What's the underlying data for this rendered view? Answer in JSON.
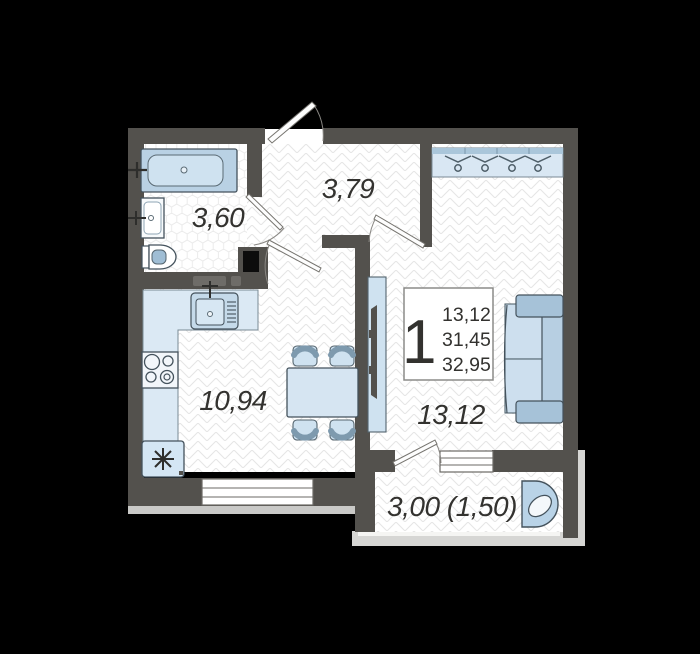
{
  "floor_plan": {
    "unit_info": {
      "rooms_count": "1",
      "area_line1": "13,12",
      "area_line2": "31,45",
      "area_line3": "32,95"
    },
    "labels": {
      "bathroom": "3,60",
      "hallway": "3,79",
      "kitchen_living": "10,94",
      "room": "13,12",
      "balcony": "3,00 (1,50)"
    },
    "icons": {
      "hanger": "hanger-icon",
      "snowflake": "snowflake-icon",
      "faucet": "faucet-cross-icon",
      "door_swing": "door-swing-arc"
    },
    "colors": {
      "background": "#000000",
      "walls": "#53514d",
      "shaft": "#0c0c0c",
      "floor": "#ffffff",
      "floor_pattern": "#e5e5e5",
      "furniture_light": "#cfe2f0",
      "furniture_medium": "#b7cfe2",
      "furniture_dark": "#a6c2d8",
      "outline": "#44525c",
      "exterior_trim": "#d6d6d4",
      "text": "#33322f"
    }
  }
}
